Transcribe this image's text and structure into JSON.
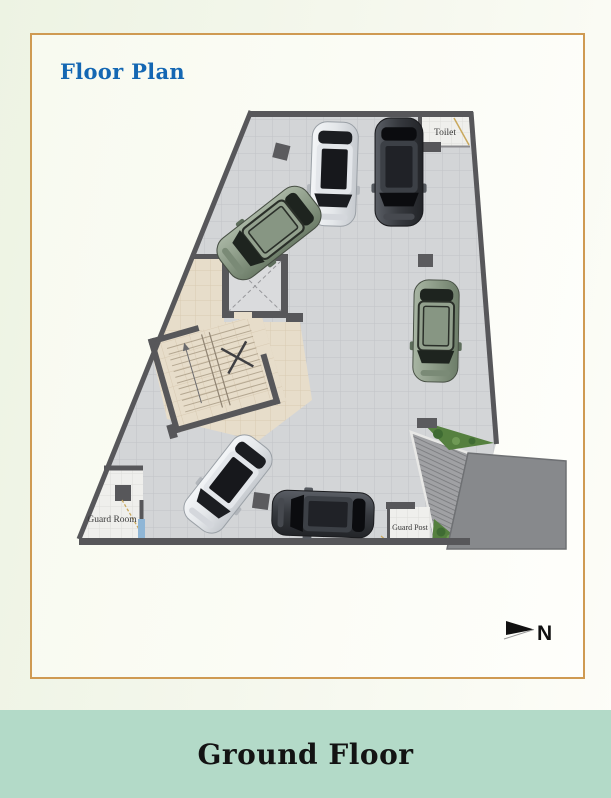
{
  "header": {
    "title": "Floor Plan",
    "color": "#1467b3"
  },
  "card": {
    "border_color": "#cf9a52",
    "background": "#fbfcf5"
  },
  "plan": {
    "labels": {
      "toilet": "Toilet",
      "guard_room": "Guard Room",
      "guard_post": "Guard Post"
    },
    "compass_label": "N",
    "cars": [
      {
        "color": "silver-white",
        "position": "top-center, facing down"
      },
      {
        "color": "dark-grey",
        "position": "top-center-right, facing down"
      },
      {
        "color": "sage-green",
        "position": "upper-left, parked diagonally"
      },
      {
        "color": "sage-green",
        "position": "right-middle, facing down"
      },
      {
        "color": "silver-white",
        "position": "bottom-left, parked diagonally"
      },
      {
        "color": "dark-grey",
        "position": "bottom-center, facing left"
      }
    ],
    "colors": {
      "floor_tile": "#d3d5d7",
      "walls": "#57575a",
      "lobby_tile": "#e7ddca",
      "driveway": "#87898c",
      "plants": "#55803f"
    }
  },
  "footer": {
    "label": "Ground Floor",
    "background": "#b3dac8",
    "text_color": "#131313"
  }
}
